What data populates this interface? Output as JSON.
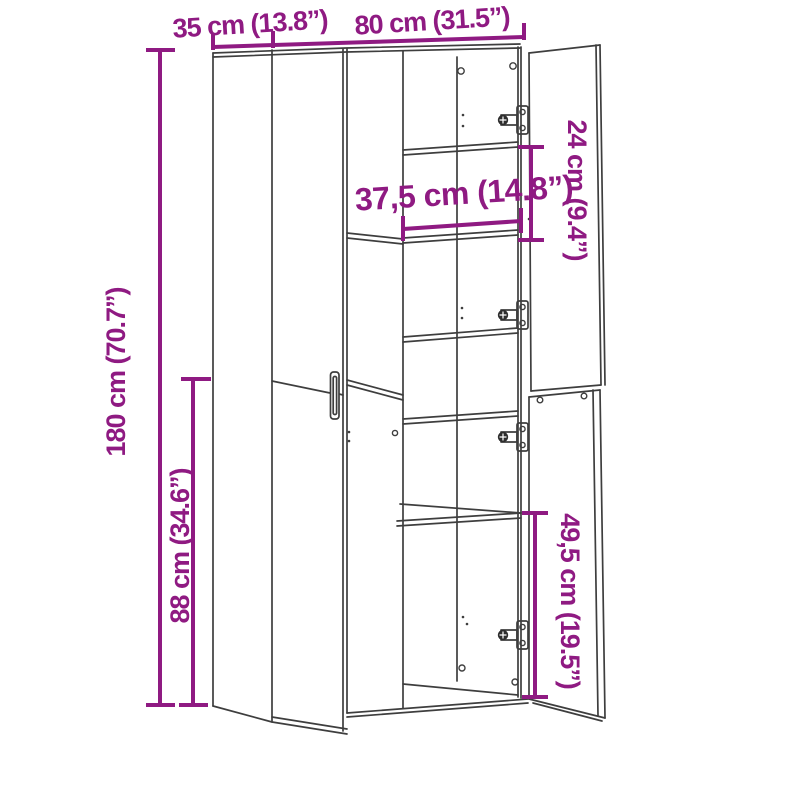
{
  "figure": {
    "title": "Wardrobe dimension diagram",
    "style": "line-drawing with magenta dimension annotations"
  },
  "dimensions": {
    "top_depth": {
      "label": "35 cm (13.8”)",
      "orientation": "horizontal-top"
    },
    "top_width": {
      "label": "80 cm (31.5”)",
      "orientation": "horizontal-top"
    },
    "left_height": {
      "label": "180 cm (70.7”)",
      "orientation": "vertical-left"
    },
    "left_lower": {
      "label": "88 cm (34.6”)",
      "orientation": "vertical-left"
    },
    "inner_width": {
      "label": "37,5 cm (14.8”)",
      "orientation": "horizontal-middle"
    },
    "right_shelf_gap": {
      "label": "24 cm (9.4”)",
      "orientation": "vertical-right"
    },
    "right_lower": {
      "label": "49,5 cm (19.5”)",
      "orientation": "vertical-right"
    }
  },
  "colors": {
    "accent": "#8F1A82",
    "line": "#3E3E3E",
    "background": "#FFFFFF"
  }
}
